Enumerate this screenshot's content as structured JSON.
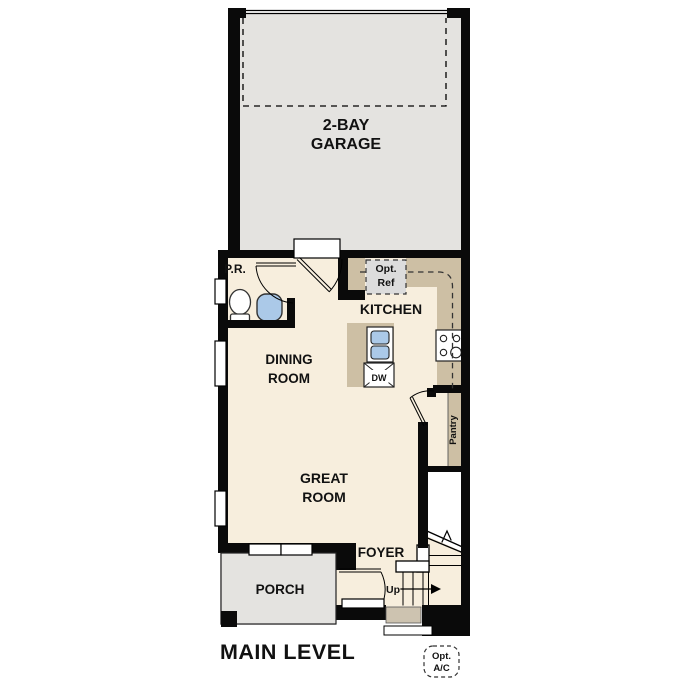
{
  "plan": {
    "title": "MAIN LEVEL",
    "garage": {
      "label_line1": "2-BAY",
      "label_line2": "GARAGE"
    },
    "kitchen": {
      "label": "KITCHEN",
      "opt_ref_line1": "Opt.",
      "opt_ref_line2": "Ref",
      "dishwasher": "DW",
      "pantry": "Pantry"
    },
    "dining": {
      "label_line1": "DINING",
      "label_line2": "ROOM"
    },
    "great_room": {
      "label_line1": "GREAT",
      "label_line2": "ROOM"
    },
    "foyer": {
      "label": "FOYER",
      "stairs_up": "Up"
    },
    "porch": {
      "label": "PORCH"
    },
    "powder_room": {
      "label": "P.R."
    },
    "hvac": {
      "line1": "Opt.",
      "line2": "A/C"
    },
    "colors": {
      "wall": "#0a0a0a",
      "floor": "#f7eedd",
      "counter": "#cdbfa4",
      "garage_floor": "#e4e3e0",
      "porch_floor": "#e4e3e0",
      "fridge_gray": "#dcdcdc",
      "fixture_blue": "#abc9e8",
      "step_tan": "#cdc3b0"
    }
  }
}
